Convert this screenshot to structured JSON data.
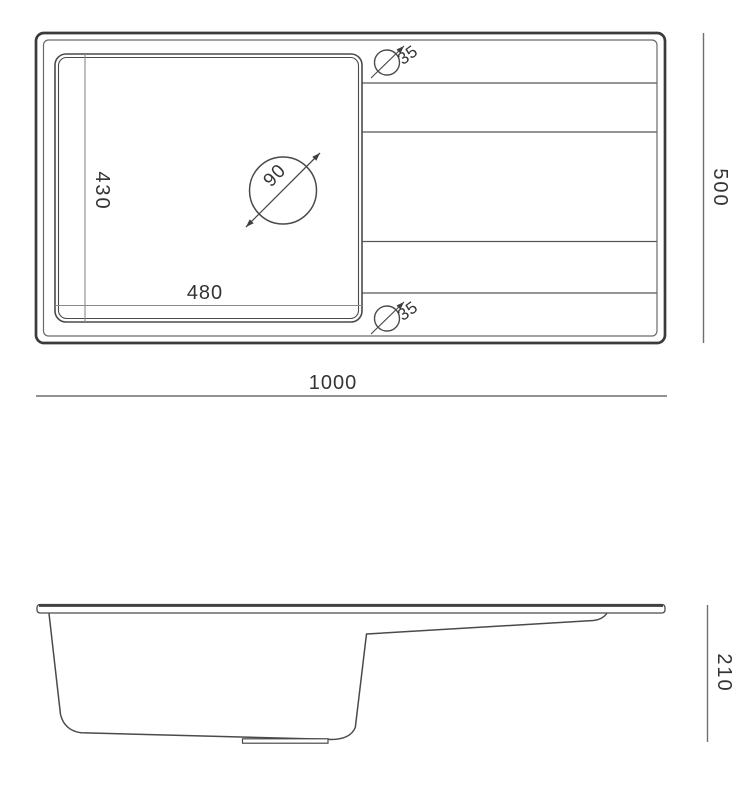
{
  "diagram": {
    "type": "technical-drawing",
    "subject": "kitchen sink with drainboard, dimensioned plan and section views",
    "units_implied": "mm",
    "top_view": {
      "overall_width": "1000",
      "overall_depth": "500",
      "bowl_width": "480",
      "bowl_depth": "430",
      "drain_diameter": "90",
      "tap_hole_top_diameter": "35",
      "tap_hole_bottom_diameter": "35",
      "drainer_groove_count": 4
    },
    "side_view": {
      "overall_height": "210"
    },
    "colors": {
      "background": "#ffffff",
      "outline_heavy": "#3b3b3b",
      "outline_medium": "#4a4a4a",
      "outline_thin": "#6a6a6a",
      "dimension_line": "#6f6f6f",
      "inner_dimension_line": "#8a8a8a",
      "text": "#343434"
    }
  }
}
